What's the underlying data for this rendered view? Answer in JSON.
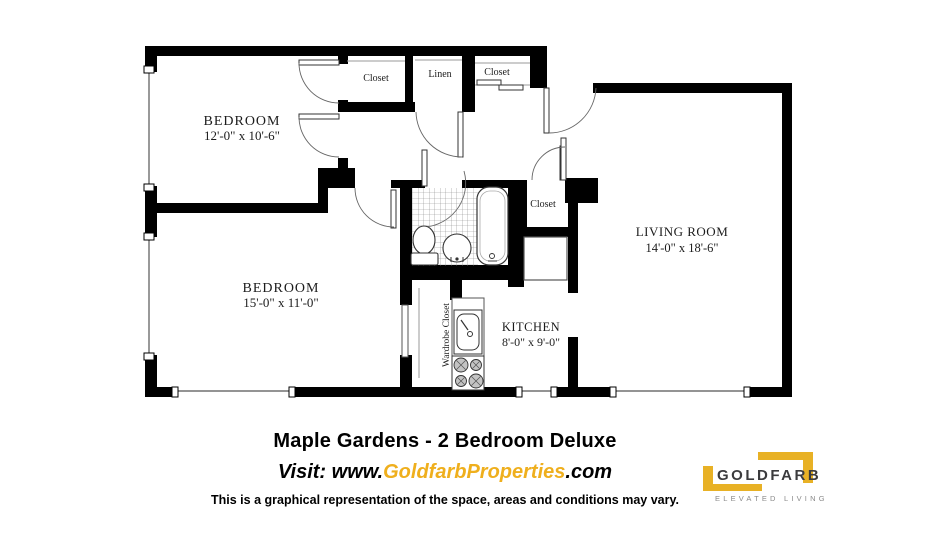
{
  "plan": {
    "bedroom1": {
      "name": "BEDROOM",
      "dims": "12'-0\" x 10'-6\""
    },
    "bedroom2": {
      "name": "BEDROOM",
      "dims": "15'-0\" x 11'-0\""
    },
    "living_room": {
      "name": "LIVING ROOM",
      "dims": "14'-0\" x 18'-6\""
    },
    "kitchen": {
      "name": "KITCHEN",
      "dims": "8'-0\" x 9'-0\""
    },
    "closet_top": "Closet",
    "closet_linen": "Linen",
    "closet_entry": "Closet",
    "closet_hall": "Closet",
    "wardrobe": "Wardrobe Closet"
  },
  "footer": {
    "title": "Maple Gardens - 2 Bedroom Deluxe",
    "visit_prefix": "Visit: www.",
    "visit_brand": "GoldfarbProperties",
    "visit_suffix": ".com",
    "disclaimer": "This is a graphical representation of the space, areas and conditions may vary."
  },
  "logo": {
    "name": "GOLDFARB",
    "tagline": "ELEVATED LIVING",
    "gold": "#E8B125",
    "text_color": "#3b3b3d",
    "accent_gold_text": "#EFAF1D"
  }
}
